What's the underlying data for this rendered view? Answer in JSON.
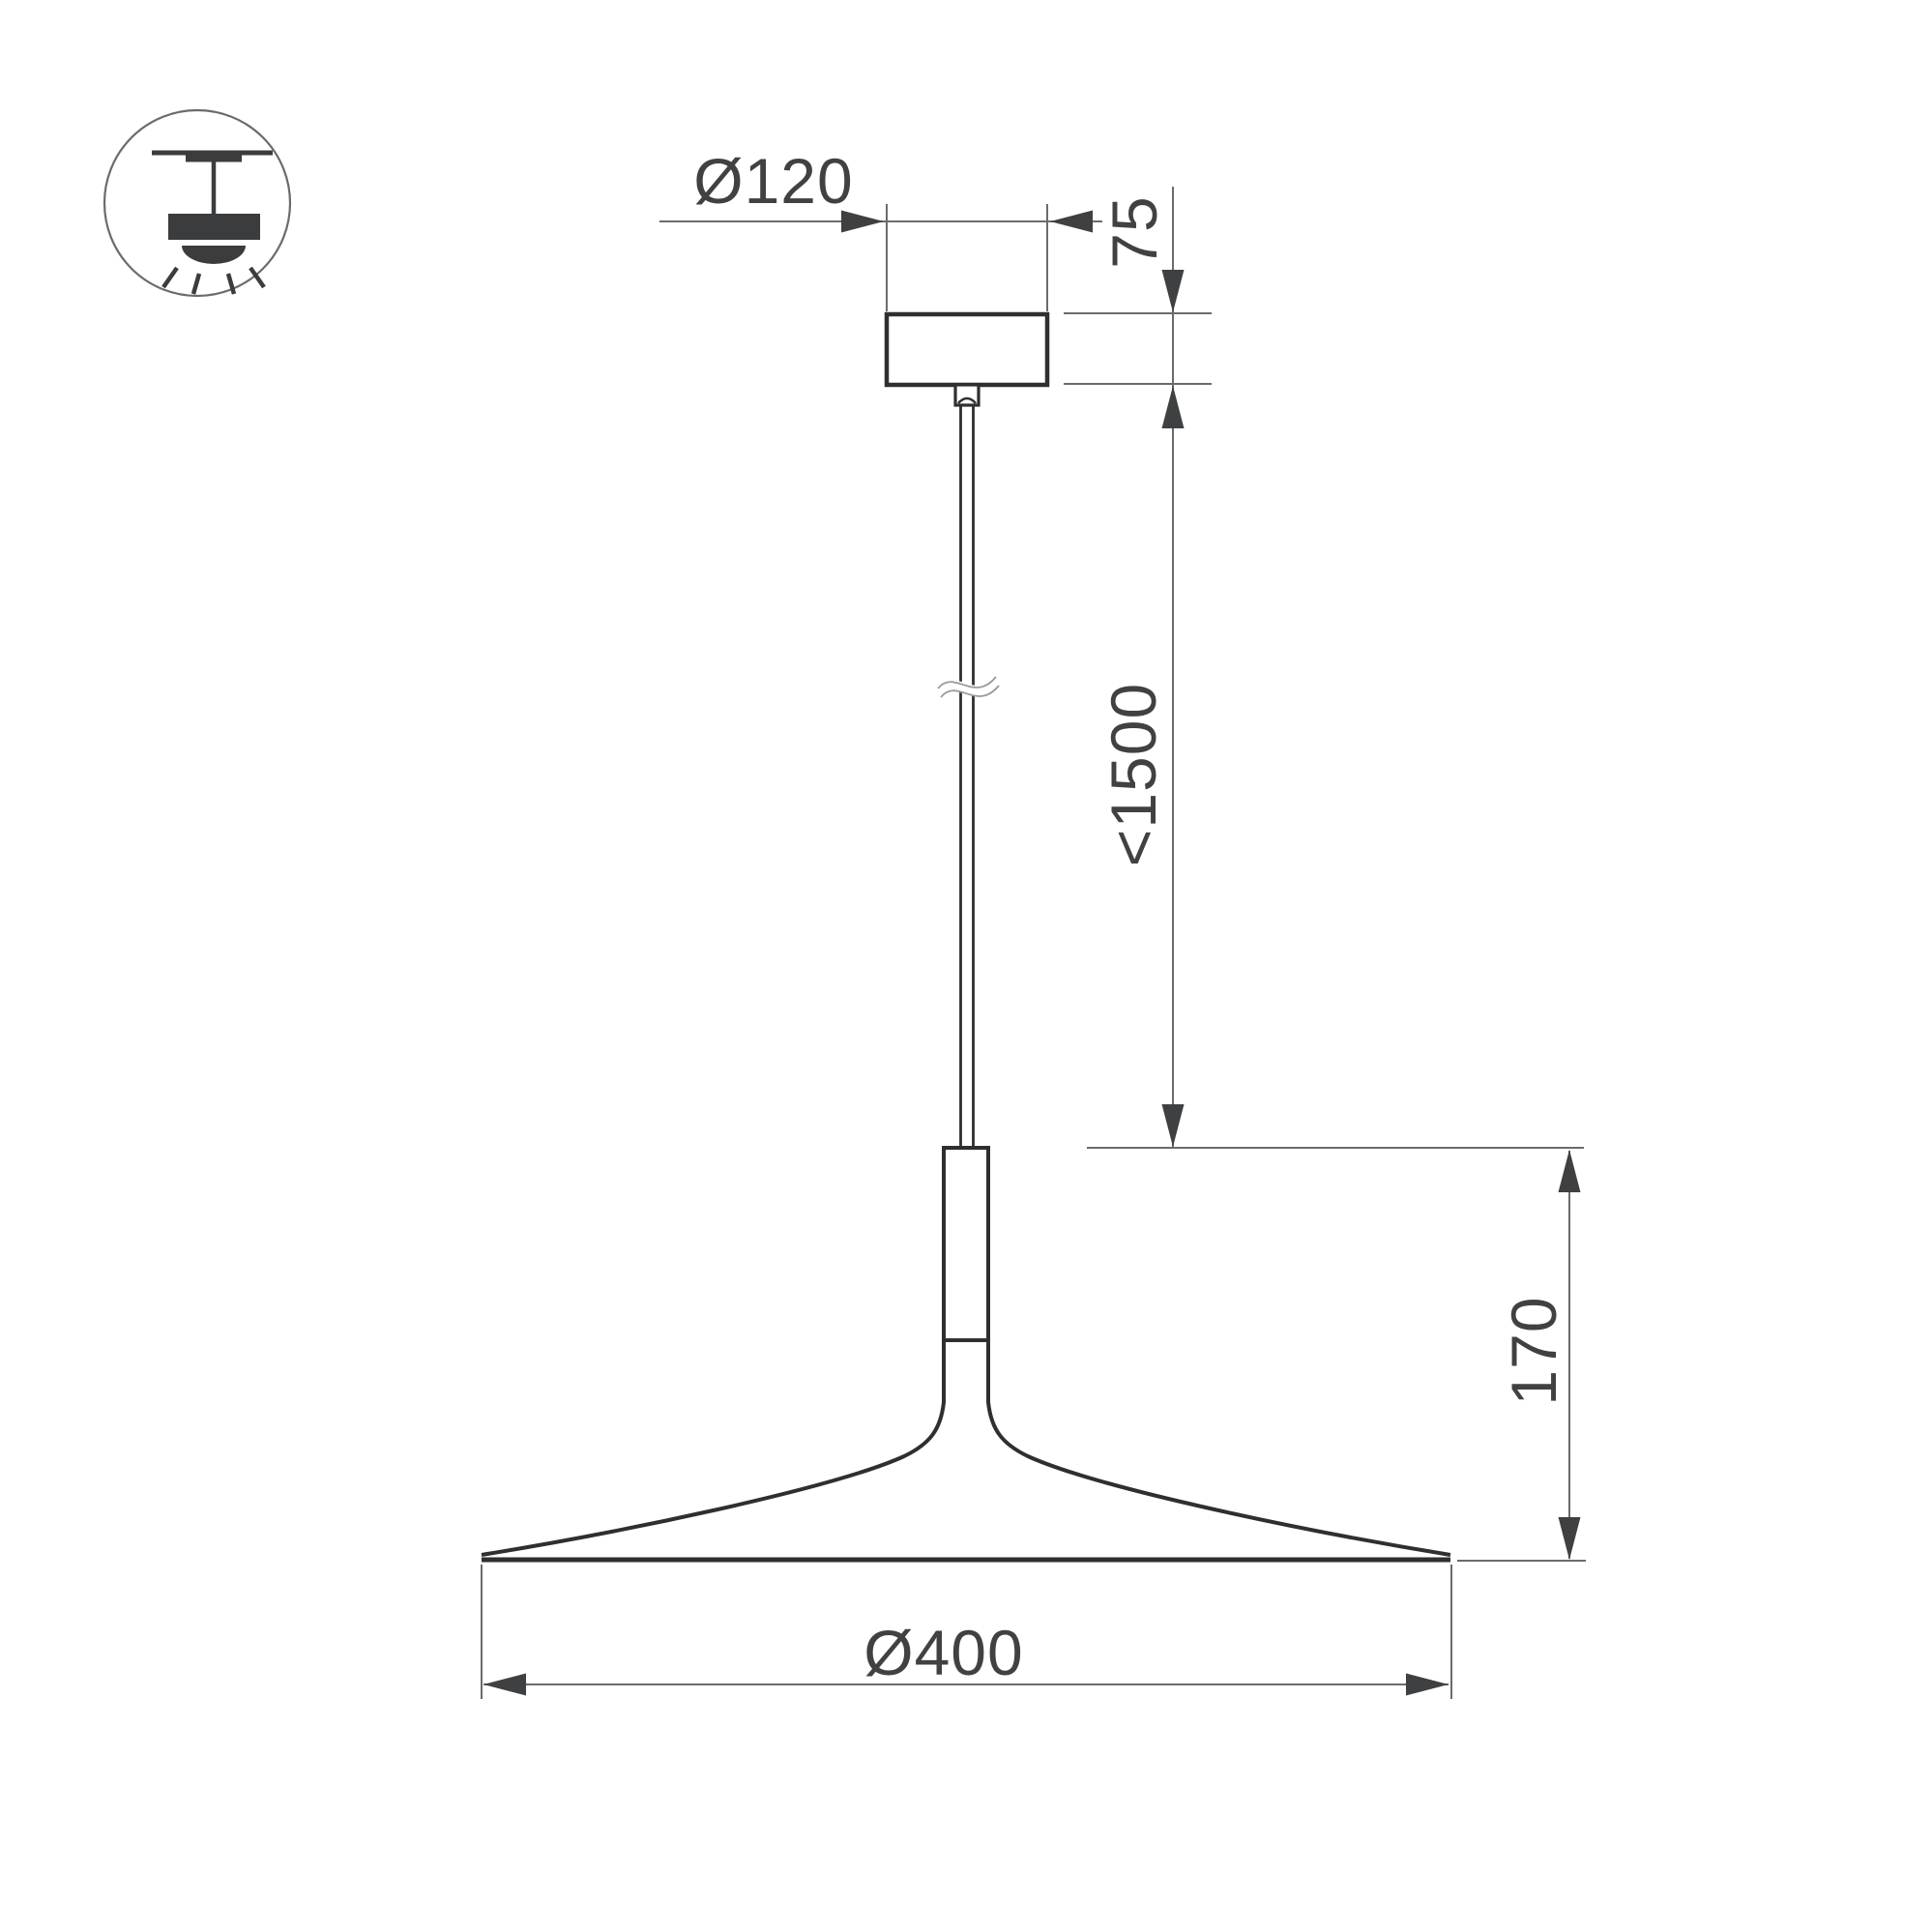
{
  "drawing": {
    "type": "technical-dimension-drawing",
    "subject": "pendant-lamp-suspension-luminaire",
    "icon": {
      "name": "pendant-ceiling-light-icon",
      "meaning": "suspended ceiling mount luminaire symbol"
    },
    "labels": {
      "canopy_diameter": "Ø120",
      "canopy_height": "75",
      "suspension_length": "<1500",
      "lamp_height": "170",
      "shade_diameter": "Ø400"
    },
    "colors": {
      "background": "#ffffff",
      "outline_bold": "#2e2f31",
      "dimension_line": "#6a6b6d",
      "arrow_fill": "#3f4042",
      "text": "#414042",
      "icon_fill": "#3b3c3e",
      "break_symbol": "#9a9a9c"
    }
  }
}
